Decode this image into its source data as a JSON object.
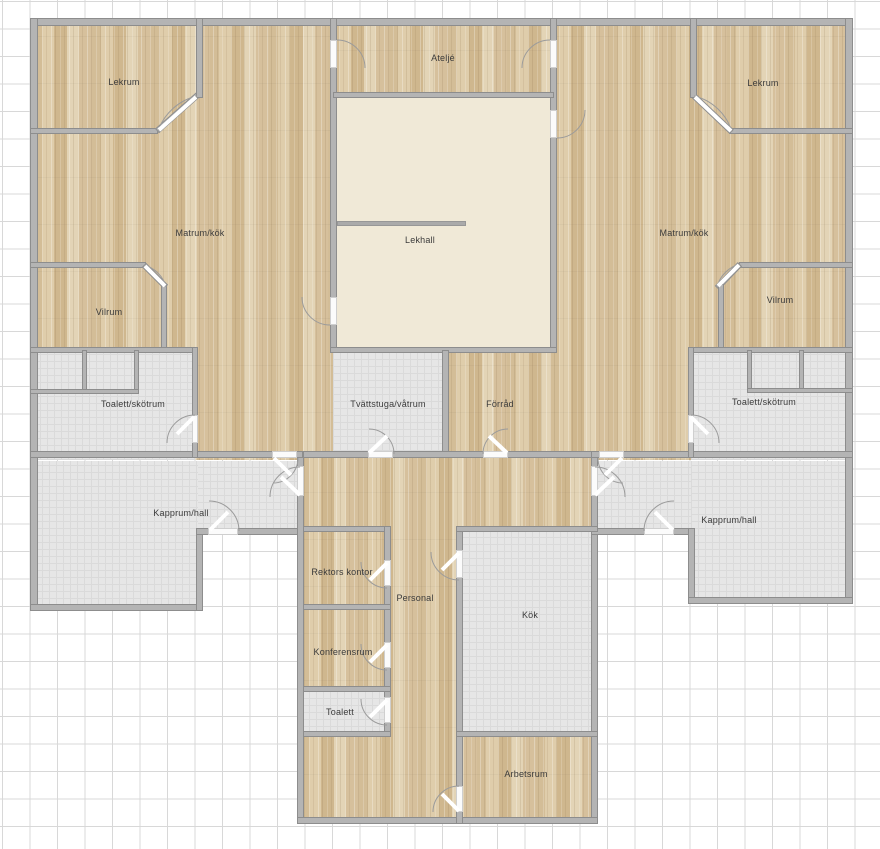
{
  "app": {
    "type": "floor-plan-viewer",
    "grid_visible": true
  },
  "colors": {
    "wood_floor": "#d7c29e",
    "tile_floor": "#e6e6e6",
    "lekhall_floor": "#f0e9d7",
    "wall": "#b4b4b4",
    "wall_outline": "#8d8d8d",
    "grid_line": "#d8d8d8",
    "label_text": "#3b3b3b"
  },
  "rooms": [
    {
      "id": "lekrum-left",
      "label": "Lekrum",
      "floor": "wood"
    },
    {
      "id": "atelje",
      "label": "Ateljé",
      "floor": "wood"
    },
    {
      "id": "lekrum-right",
      "label": "Lekrum",
      "floor": "wood"
    },
    {
      "id": "matrum-kok-left",
      "label": "Matrum/kök",
      "floor": "wood"
    },
    {
      "id": "lekhall",
      "label": "Lekhall",
      "floor": "plain"
    },
    {
      "id": "matrum-kok-right",
      "label": "Matrum/kök",
      "floor": "wood"
    },
    {
      "id": "vilrum-left",
      "label": "Vilrum",
      "floor": "wood"
    },
    {
      "id": "vilrum-right",
      "label": "Vilrum",
      "floor": "wood"
    },
    {
      "id": "toalett-skotrum-left",
      "label": "Toalett/skötrum",
      "floor": "tile"
    },
    {
      "id": "tvattstuga-vatrum",
      "label": "Tvättstuga/våtrum",
      "floor": "tile"
    },
    {
      "id": "forrad",
      "label": "Förråd",
      "floor": "wood"
    },
    {
      "id": "toalett-skotrum-right",
      "label": "Toalett/skötrum",
      "floor": "tile"
    },
    {
      "id": "kapprum-hall-left",
      "label": "Kapprum/hall",
      "floor": "tile"
    },
    {
      "id": "kapprum-hall-right",
      "label": "Kapprum/hall",
      "floor": "tile"
    },
    {
      "id": "rektors-kontor",
      "label": "Rektors kontor",
      "floor": "wood"
    },
    {
      "id": "personal",
      "label": "Personal",
      "floor": "wood"
    },
    {
      "id": "konferensrum",
      "label": "Konferensrum",
      "floor": "wood"
    },
    {
      "id": "toalett",
      "label": "Toalett",
      "floor": "tile"
    },
    {
      "id": "kok",
      "label": "Kök",
      "floor": "tile"
    },
    {
      "id": "arbetsrum",
      "label": "Arbetsrum",
      "floor": "wood"
    }
  ]
}
